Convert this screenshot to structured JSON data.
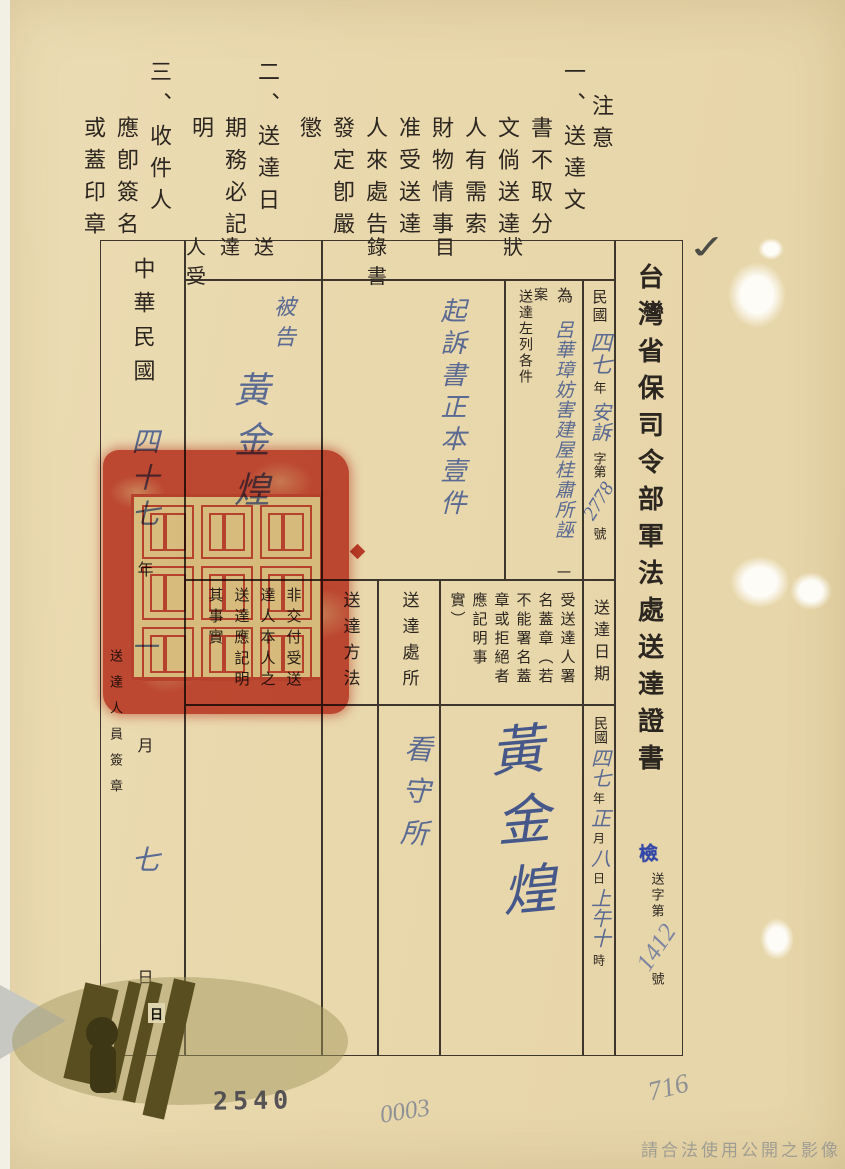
{
  "doc": {
    "notice": {
      "label": "注意",
      "items": [
        "一、送達文書不取分文倘送達人有需索財物情事准受送達人來處告發定卽嚴懲",
        "二、送達日期務必記明",
        "三、收件人應卽簽名或蓋印章"
      ]
    },
    "title": "台灣省保司令部軍法處送達證書",
    "title_stamp": "檢",
    "dispatch_no": {
      "prefix": "送字第",
      "number": "1412",
      "suffix": "號"
    },
    "case_ref": {
      "era": "民國",
      "year": "四七",
      "year_unit": "年",
      "case_word": "安訴",
      "word": "字第",
      "number": "2778",
      "number_unit": "號"
    },
    "purpose": {
      "for_label": "為",
      "case_name": "呂華璋妨害建屋桂肅所誣",
      "case_unit": "一案",
      "deliver_label": "送達左列各件"
    },
    "headers": {
      "document_list": "書狀目錄",
      "recipient": "受送達人",
      "delivery_date": "送達日期",
      "recipient_signature": "受送達人署名蓋章（若不能署名蓋章或拒絕者應記明事實）",
      "delivery_place": "送達處所",
      "delivery_method": "送達方法",
      "note": "非交付受送達人本人之送達應記明其事實"
    },
    "entries": {
      "document_list": "起訴書正本壹件",
      "recipient_role": "被告",
      "recipient_name": "黃金煌",
      "signature": "黃金煌",
      "place": "看守所",
      "delivery_date": {
        "era": "民國",
        "year": "四七",
        "year_unit": "年",
        "month": "正",
        "month_unit": "月",
        "day": "八",
        "day_unit": "日",
        "time": "上午十",
        "time_unit": "時"
      }
    },
    "left_column": {
      "era": "中華民國",
      "year": "四十七",
      "year_unit": "年",
      "month": "一",
      "month_unit": "月",
      "day": "七",
      "day_unit": "日",
      "signer_label": "送達人員簽章"
    },
    "marks": {
      "checkmark": "✓",
      "archive_stamp": "2540",
      "pencil_left": "0003",
      "pencil_right": "716",
      "logo_glyph": "日"
    },
    "footer": {
      "notice": "請合法使用公開之影像"
    }
  }
}
